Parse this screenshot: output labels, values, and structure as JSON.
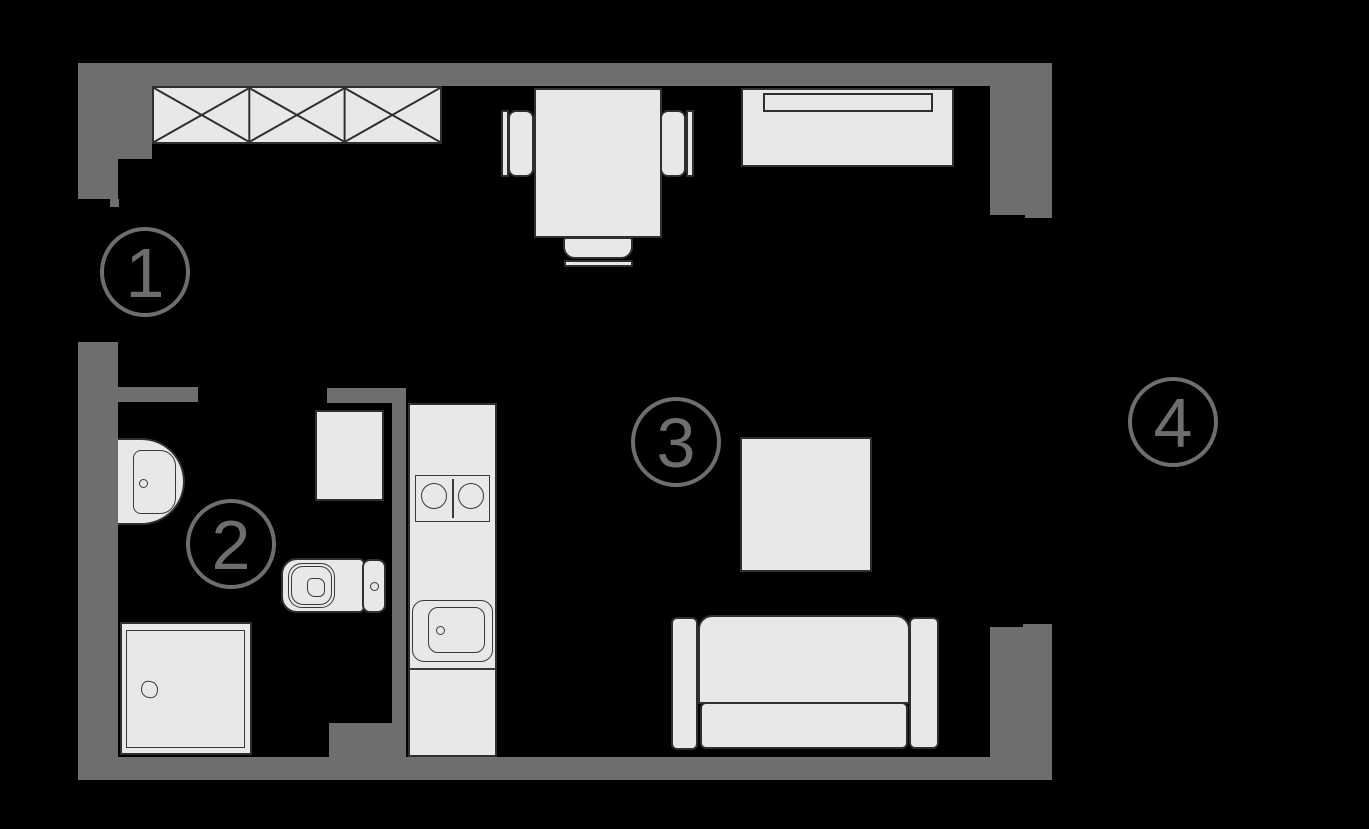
{
  "colors": {
    "background": "#000000",
    "wall": "#6e6e6e",
    "furniture_fill": "#e8e8e8",
    "furniture_outline": "#2f2f2f",
    "detail_outline": "#3a3a3a",
    "label": "#6e6e6e"
  },
  "rooms": [
    {
      "label": "1"
    },
    {
      "label": "2"
    },
    {
      "label": "3"
    },
    {
      "label": "4"
    }
  ],
  "fixtures": [
    "wardrobe-icon",
    "dining-table-icon",
    "chair-icon",
    "bed-icon",
    "washbasin-icon",
    "washing-machine-icon",
    "toilet-icon",
    "shower-icon",
    "kitchen-counter-icon",
    "cooktop-icon",
    "kitchen-sink-icon",
    "coffee-table-icon",
    "sofa-icon"
  ]
}
